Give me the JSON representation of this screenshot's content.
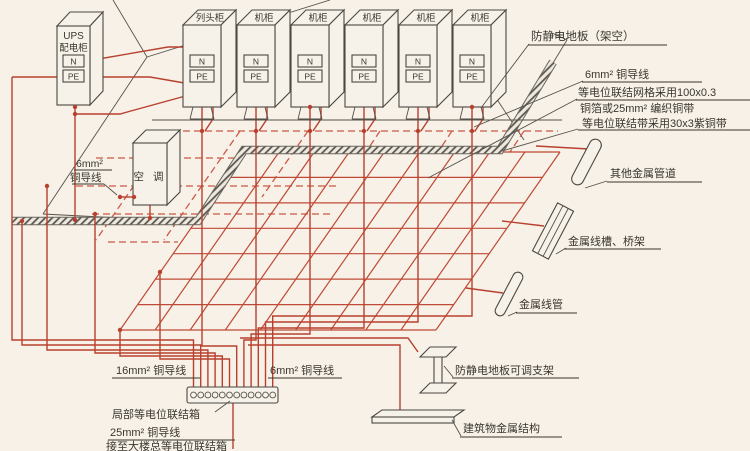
{
  "diagram_title": "机房防静电地板等电位联结示意图",
  "colors": {
    "wire_red": "#b8402e",
    "line_black": "#4a4842",
    "paper": "#f7f1e8"
  },
  "ups": {
    "line1": "UPS",
    "line2": "配电柜",
    "n": "N",
    "pe": "PE"
  },
  "cabinets": {
    "n": "N",
    "pe": "PE",
    "names": [
      "列头柜",
      "机柜",
      "机柜",
      "机柜",
      "机柜",
      "机柜"
    ]
  },
  "aircon": {
    "label": "空 调"
  },
  "left_wire_label": {
    "line1": "6mm²",
    "line2": "铜导线"
  },
  "right_labels": {
    "floor": "防静电地板（架空）",
    "wire6": "6mm² 铜导线",
    "grid1": "等电位联结网格采用100x0.3",
    "grid2": "铜箔或25mm² 编织铜带",
    "band": "等电位联结带采用30x3紫铜带",
    "pipe_other": "其他金属管道",
    "tray": "金属线槽、桥架",
    "conduit": "金属线管",
    "pedestal": "防静电地板可调支架",
    "structure": "建筑物金属结构"
  },
  "bottom_labels": {
    "wire16": "16mm² 铜导线",
    "wire6": "6mm² 铜导线",
    "leb_box": "局部等电位联结箱",
    "wire25": "25mm² 铜导线",
    "to_main": "接至大楼总等电位联结箱"
  }
}
